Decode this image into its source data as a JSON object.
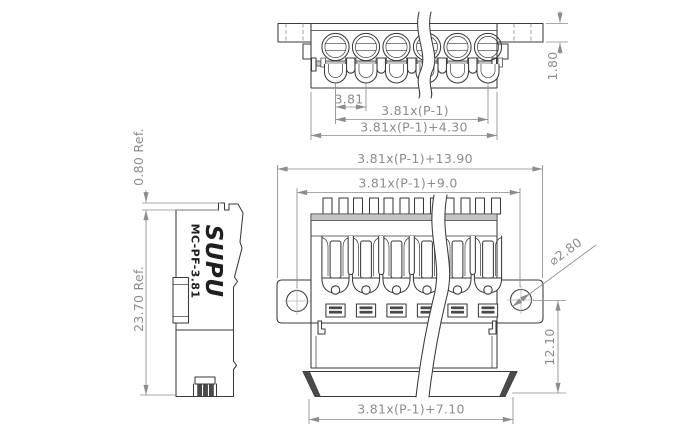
{
  "drawing": {
    "background": "#ffffff",
    "outline_color": "#3a3a3a",
    "dimension_color": "#8c8c8c",
    "views": {
      "top": {
        "pitch": "3.81",
        "span": "3.81x(P-1)",
        "overall_width": "3.81x(P-1)+4.30",
        "tab_height": "1.80"
      },
      "side": {
        "brand": "SUPU",
        "model": "MC-PF-3.81",
        "latch_ref": "0.80 Ref.",
        "height_ref": "23.70 Ref."
      },
      "front": {
        "flange_width": "3.81x(P-1)+13.90",
        "hole_spacing": "3.81x(P-1)+9.0",
        "hole_diameter": "⌀2.80",
        "lower_height": "12.10",
        "base_width": "3.81x(P-1)+7.10"
      }
    }
  }
}
